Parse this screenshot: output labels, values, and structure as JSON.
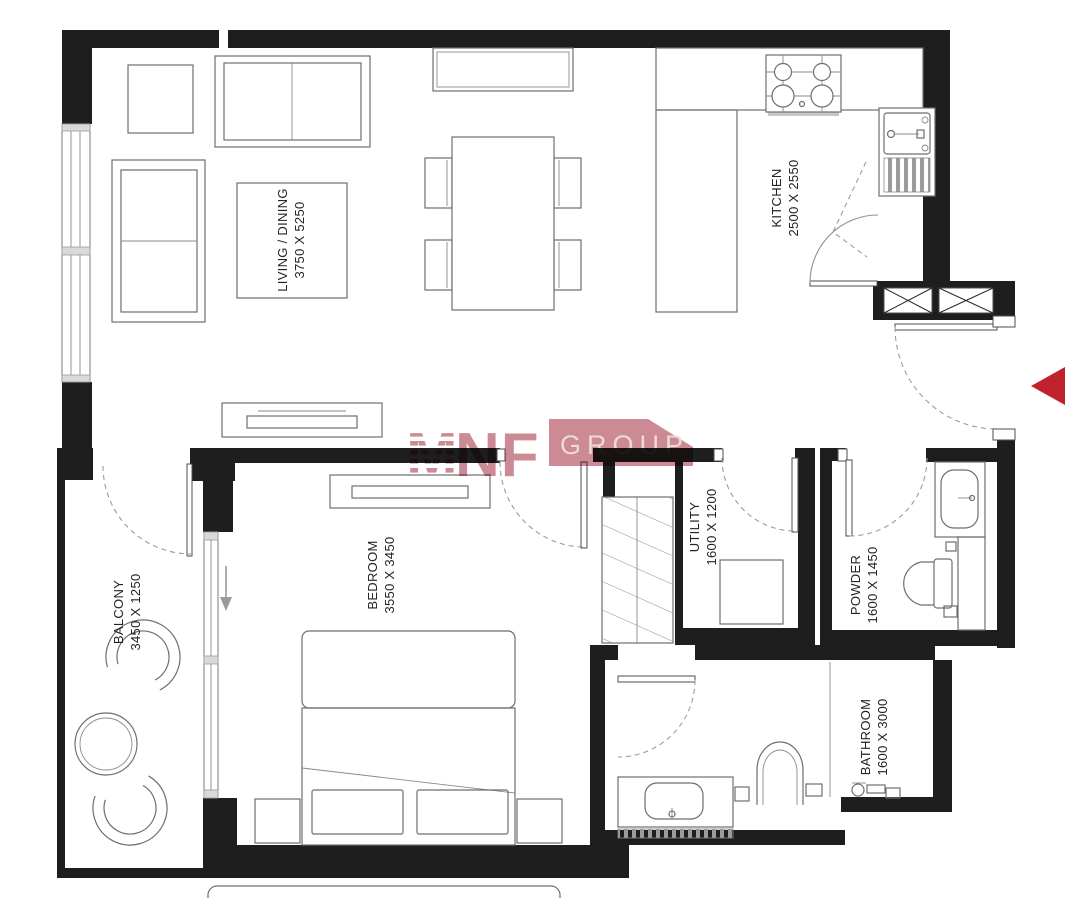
{
  "plan": {
    "rooms": [
      {
        "name": "LIVING / DINING",
        "dims": "3750 X 5250"
      },
      {
        "name": "KITCHEN",
        "dims": "2500 X 2550"
      },
      {
        "name": "BALCONY",
        "dims": "3450 X 1250"
      },
      {
        "name": "BEDROOM",
        "dims": "3550 X 3450"
      },
      {
        "name": "UTILITY",
        "dims": "1600 X 1200"
      },
      {
        "name": "POWDER",
        "dims": "1600 X 1450"
      },
      {
        "name": "BATHROOM",
        "dims": "1600 X 3000"
      }
    ]
  },
  "watermark": {
    "m": "M",
    "nf": "NF",
    "group": "GROUP"
  },
  "colors": {
    "wall": "#1e1e1e",
    "line": "#6e6e6e",
    "door_arc": "#9b9b9b",
    "glass": "#7a7a7a",
    "watermark": "#c9848e",
    "watermark_text": "#ecd6da",
    "entry_marker": "#c0222d"
  }
}
